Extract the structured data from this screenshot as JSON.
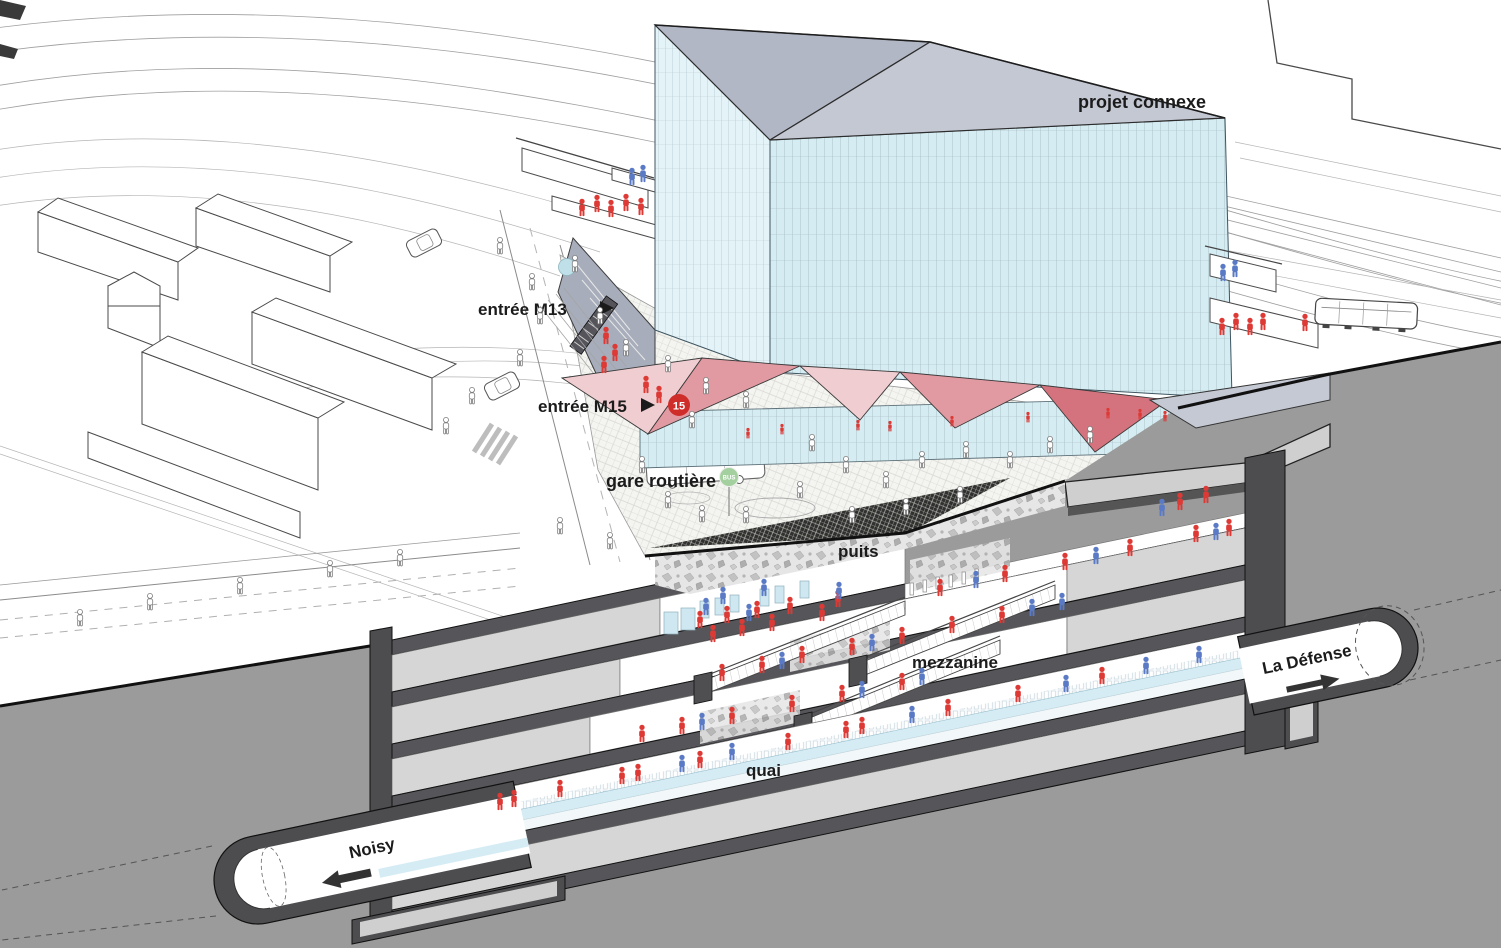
{
  "figure": {
    "kind": "axonometric-section-diagram",
    "subject": "metro station cut-away with connected building project"
  },
  "labels": {
    "projet_connexe": "projet connexe",
    "entree_m13": "entrée M13",
    "entree_m15": "entrée M15",
    "gare_routiere": "gare routière",
    "puits": "puits",
    "mezzanine": "mezzanine",
    "quai": "quai",
    "noisy": "Noisy",
    "la_defense": "La Défense"
  },
  "badges": {
    "line15": "15",
    "bus": "BUS"
  },
  "colors": {
    "ground": "#9b9b9b",
    "wall_dark": "#4d4d50",
    "slab": "#56565a",
    "floor_light": "#d6d6d6",
    "deck": "#cfcfcf",
    "quai_blue": "#d5ecf5",
    "roof_a": "#b2b7c5",
    "roof_b": "#c4c8d3",
    "podium": "#c5c9d4",
    "wedge": "#a7adbb",
    "canopy_light": "#f0cdd1",
    "canopy_mid": "#e29aa2",
    "canopy_dark": "#d4737d",
    "person_red": "#dd3a36",
    "person_blue": "#5b7ac5",
    "badge_red": "#cf2d2a",
    "bus_green": "#a3d09e",
    "m13_disc": "#bfe0e8",
    "ink": "#1b1b1b"
  },
  "people": {
    "red": [
      [
        582,
        212
      ],
      [
        597,
        208
      ],
      [
        611,
        213
      ],
      [
        626,
        207
      ],
      [
        641,
        211
      ],
      [
        606,
        340
      ],
      [
        615,
        357
      ],
      [
        604,
        369
      ],
      [
        646,
        389
      ],
      [
        659,
        399
      ],
      [
        1222,
        331
      ],
      [
        1236,
        326
      ],
      [
        1250,
        331
      ],
      [
        1263,
        326
      ],
      [
        1305,
        327
      ],
      [
        700,
        624
      ],
      [
        713,
        638
      ],
      [
        727,
        619
      ],
      [
        742,
        632
      ],
      [
        757,
        614
      ],
      [
        772,
        627
      ],
      [
        790,
        610
      ],
      [
        822,
        617
      ],
      [
        838,
        603
      ],
      [
        940,
        592
      ],
      [
        1005,
        578
      ],
      [
        1065,
        566
      ],
      [
        1130,
        552
      ],
      [
        1196,
        538
      ],
      [
        1229,
        532
      ],
      [
        1180,
        506
      ],
      [
        1206,
        499
      ],
      [
        762,
        669
      ],
      [
        802,
        659
      ],
      [
        852,
        651
      ],
      [
        902,
        640
      ],
      [
        952,
        629
      ],
      [
        1002,
        619
      ],
      [
        722,
        677
      ],
      [
        642,
        738
      ],
      [
        682,
        730
      ],
      [
        732,
        720
      ],
      [
        792,
        708
      ],
      [
        842,
        698
      ],
      [
        902,
        686
      ],
      [
        500,
        806
      ],
      [
        514,
        803
      ],
      [
        560,
        793
      ],
      [
        622,
        780
      ],
      [
        638,
        777
      ],
      [
        700,
        764
      ],
      [
        788,
        746
      ],
      [
        846,
        734
      ],
      [
        862,
        730
      ],
      [
        948,
        712
      ],
      [
        1018,
        698
      ],
      [
        1102,
        680
      ]
    ],
    "blue": [
      [
        632,
        181
      ],
      [
        643,
        178
      ],
      [
        1223,
        277
      ],
      [
        1235,
        273
      ],
      [
        706,
        611
      ],
      [
        723,
        600
      ],
      [
        749,
        617
      ],
      [
        764,
        592
      ],
      [
        839,
        595
      ],
      [
        976,
        584
      ],
      [
        1096,
        560
      ],
      [
        1216,
        536
      ],
      [
        1162,
        512
      ],
      [
        782,
        665
      ],
      [
        872,
        647
      ],
      [
        1032,
        612
      ],
      [
        1062,
        606
      ],
      [
        702,
        726
      ],
      [
        862,
        694
      ],
      [
        922,
        681
      ],
      [
        682,
        768
      ],
      [
        732,
        756
      ],
      [
        912,
        719
      ],
      [
        1066,
        688
      ],
      [
        1146,
        670
      ],
      [
        1199,
        659
      ]
    ],
    "outline": [
      [
        575,
        268
      ],
      [
        600,
        320
      ],
      [
        626,
        352
      ],
      [
        668,
        368
      ],
      [
        706,
        390
      ],
      [
        746,
        404
      ],
      [
        692,
        424
      ],
      [
        642,
        469
      ],
      [
        668,
        504
      ],
      [
        702,
        518
      ],
      [
        746,
        519
      ],
      [
        800,
        494
      ],
      [
        846,
        469
      ],
      [
        886,
        484
      ],
      [
        922,
        464
      ],
      [
        966,
        454
      ],
      [
        1010,
        464
      ],
      [
        1050,
        449
      ],
      [
        1090,
        439
      ],
      [
        960,
        499
      ],
      [
        906,
        511
      ],
      [
        852,
        519
      ],
      [
        812,
        447
      ],
      [
        540,
        320
      ],
      [
        520,
        362
      ],
      [
        472,
        400
      ],
      [
        446,
        430
      ],
      [
        80,
        622
      ],
      [
        150,
        606
      ],
      [
        240,
        590
      ],
      [
        330,
        573
      ],
      [
        400,
        562
      ],
      [
        500,
        250
      ],
      [
        532,
        286
      ],
      [
        560,
        530
      ],
      [
        610,
        545
      ]
    ],
    "cafe": [
      [
        748,
        436
      ],
      [
        782,
        432
      ],
      [
        858,
        428
      ],
      [
        890,
        429
      ],
      [
        952,
        424
      ],
      [
        1028,
        420
      ],
      [
        1108,
        416
      ],
      [
        1140,
        417
      ],
      [
        1165,
        419
      ]
    ]
  }
}
